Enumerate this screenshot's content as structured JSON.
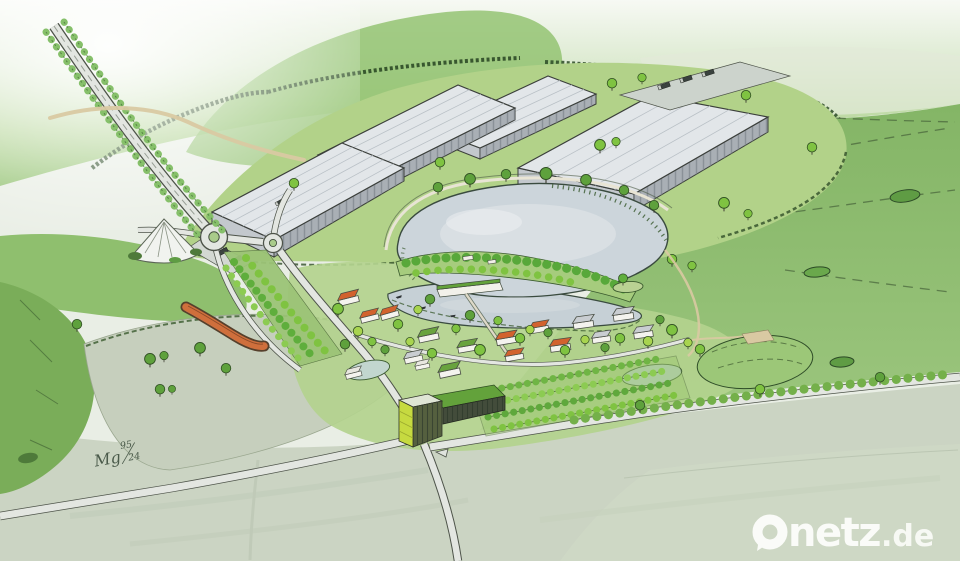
{
  "scene": {
    "description": "Hand-drawn aerial perspective sketch of a planned development: large industrial halls on a green plateau, a lake with wooded peninsula and small island, a lakeside boathouse, a village of small houses, orchard rows, a green cube building, roads with two roundabouts, a conical spoil hill, a curved red-roofed farm building, meadows and fields"
  },
  "watermark": {
    "text": "Onetz.de",
    "main": "netz",
    "suffix": ".de",
    "color": "#fdfdfb"
  },
  "signature": {
    "full": "Mg 95/24",
    "initials": "Mg",
    "numerator": "95",
    "denominator": "24"
  },
  "palette": {
    "background": "#e9eee5",
    "hill_green": "#8ec06c",
    "field_green": "#8fbb72",
    "meadow_pale": "#c6cfbd",
    "bottom_field": "#cbd4c3",
    "lake": "#ccd5db",
    "pond": "#c2d6cf",
    "road_fill": "#e3e6e1",
    "road_casing": "#4d5349",
    "hall_wall": "#a9afb5",
    "hall_wall_end": "#c3c8cd",
    "hall_roof": "#e2e6e9",
    "tree_bright": "#7fc341",
    "tree_light": "#a8d44f",
    "tree_dark": "#5ea13c",
    "roof_orange": "#d2622e",
    "roof_green": "#69a33e",
    "roof_grey": "#c9cdd1",
    "roof_white": "#e8e7e0",
    "cube_lime": "#c6da40",
    "curved_roof": "#cf6f3c",
    "path_tan": "#d9c9a2",
    "hedge_dark": "#2f4d28"
  }
}
